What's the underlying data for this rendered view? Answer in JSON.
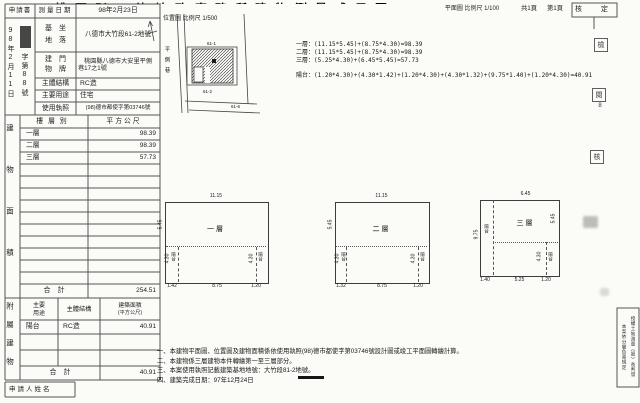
{
  "document": {
    "title": "桃園縣八德地政事務所建物測量成果圖",
    "sheet_total": "共1頁",
    "sheet_no": "第1頁",
    "approval_label": "核　定"
  },
  "header": {
    "applicant_label": "申請書",
    "survey_date_label": "測量日期",
    "survey_date_value": "98年2月23日",
    "receive_date_vertical": "98年2月11日",
    "receive_no_vertical": "字第88號"
  },
  "info": {
    "site_label_l1": "基　坐",
    "site_label_l2": "地　落",
    "site_value": "八德市大竹段61-2地號",
    "address_label_l1": "建　門",
    "address_label_l2": "物　牌",
    "address_value_l1": "桃園縣八德市大安里平側",
    "address_value_l2": "巷17之1號",
    "structure_label": "主體結構",
    "structure_value": "RC造",
    "use_label": "主要用途",
    "use_value": "住宅",
    "license_label": "使用執照",
    "license_value": "(98)德市都使字第03746號"
  },
  "area_table": {
    "section_label": "建物面積",
    "col_floor": "樓層別",
    "col_area": "平方公尺",
    "rows": [
      {
        "floor": "一層",
        "area": "98.39"
      },
      {
        "floor": "二層",
        "area": "98.39"
      },
      {
        "floor": "三層",
        "area": "57.73"
      }
    ],
    "total_label": "合　計",
    "total_value": "254.51"
  },
  "annex_table": {
    "section_label": "附屬建物",
    "col_use_l1": "主要",
    "col_use_l2": "用途",
    "col_structure": "主體結構",
    "col_area_l1": "建築面積",
    "col_area_l2": "(平方公尺)",
    "row": {
      "use": "陽台",
      "structure": "RC造",
      "area": "40.91"
    },
    "total_label": "合　計",
    "total_value": "40.91"
  },
  "applicant": {
    "name_label": "申請人姓名"
  },
  "site_plan": {
    "caption": "位置圖  比例尺 1/500",
    "lane_name": "平側巷",
    "parcel_top": "61-1",
    "parcel_main": "61-2",
    "parcel_right": "61-6"
  },
  "plan_caption": "平面圖  比例尺 1/100",
  "formulas": {
    "l1": "一層：(11.15*5.45)+(8.75*4.30)=98.39",
    "l2": "二層：(11.15*5.45)+(8.75*4.30)=98.39",
    "l3": "三層：(5.25*4.30)+(6.45*5.45)=57.73",
    "balcony": "陽台：(1.20*4.30)+(4.30*1.42)+(1.20*4.30)+(4.30*1.32)+(9.75*1.40)+(1.20*4.30)=40.91"
  },
  "floor_plans": [
    {
      "name": "一層",
      "dim_top": "11.15",
      "dim_left_upper": "5.45",
      "dim_left_lower": "4.30",
      "dim_right_lower": "4.30",
      "dim_bottom_left": "1.42",
      "dim_bottom_mid": "8.75",
      "dim_bottom_right": "1.20",
      "balcony_left": "陽台",
      "balcony_right": "陽台"
    },
    {
      "name": "二層",
      "dim_top": "11.15",
      "dim_left_upper": "5.45",
      "dim_left_lower": "4.30",
      "dim_right_lower": "4.30",
      "dim_bottom_left": "1.32",
      "dim_bottom_mid": "8.75",
      "dim_bottom_right": "1.20",
      "balcony_left": "陽台",
      "balcony_right": "陽台"
    },
    {
      "name": "三層",
      "dim_top": "6.45",
      "dim_left": "9.75",
      "dim_right_upper": "5.45",
      "dim_right_lower": "4.30",
      "dim_bottom_left": "1.40",
      "dim_bottom_mid": "5.25",
      "dim_bottom_right": "1.20",
      "balcony_left": "陽台",
      "balcony_right": "陽台"
    }
  ],
  "notes": {
    "n1": "一、本建物平面圖、位置圖及建物面積係依使用執照(98)德市都使字第03746號設計圖或竣工平面圖轉繪計算。",
    "n2": "二、本建物係三層建物本件轉繪第一至三層部分。",
    "n3": "三、本案使用執照記載建築基地地號：大竹段81-2地號。",
    "n4": "四、建築完成日期：97年12月24日"
  },
  "stamps": {
    "s1": "檢",
    "s2": "閱",
    "s2_num": "8",
    "s3": "核",
    "authority_col1": "授權土地測量（股）長判發",
    "authority_col2": "本案依分層負責規定"
  },
  "colors": {
    "ink": "#1c1c1c",
    "line": "#5a5a5a",
    "paper": "#fbfbf8"
  }
}
